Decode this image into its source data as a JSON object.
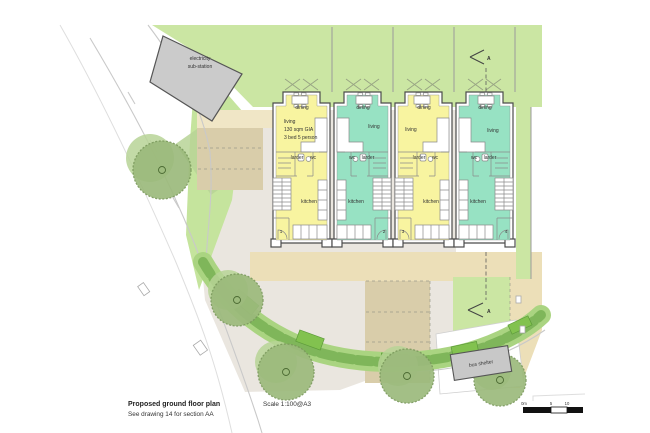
{
  "palette": {
    "garden_green": "#cbe6a3",
    "verge_green": "#c5e49d",
    "tree_green": "#9cba7c",
    "tree_green_light": "#b7d396",
    "hedge_green": "#7fb65a",
    "hedge_light": "#aad481",
    "planter_green": "#82c24f",
    "house_yellow": "#f8f4a0",
    "house_teal": "#97e2c3",
    "tan": "#ecdfb8",
    "tan_light": "#f0e6c6",
    "tan_dark": "#d9cdaa",
    "courtyard_grey": "#eae6df",
    "substation_grey": "#cbcbcb",
    "shelter_grey": "#c8c8c8"
  },
  "site": {
    "substation_line1": "electricity",
    "substation_line2": "sub-station",
    "bus_shelter": "bus shelter",
    "section_marker_top": "A",
    "section_marker_bottom": "A"
  },
  "units": [
    {
      "number": "1",
      "color": "#f8f4a0",
      "rooms": {
        "dining": "dining",
        "living": "living",
        "larder": "larder",
        "wc": "wc",
        "kitchen": "kitchen"
      },
      "note_line1": "130 sqm GIA",
      "note_line2": "3 bed 5 person"
    },
    {
      "number": "2",
      "color": "#97e2c3",
      "rooms": {
        "dining": "dining",
        "living": "living",
        "larder": "larder",
        "wc": "wc",
        "kitchen": "kitchen"
      }
    },
    {
      "number": "3",
      "color": "#f8f4a0",
      "rooms": {
        "dining": "dining",
        "living": "living",
        "larder": "larder",
        "wc": "wc",
        "kitchen": "kitchen"
      }
    },
    {
      "number": "4",
      "color": "#97e2c3",
      "rooms": {
        "dining": "dining",
        "living": "living",
        "larder": "larder",
        "wc": "wc",
        "kitchen": "kitchen"
      }
    }
  ],
  "title_block": {
    "title": "Proposed ground floor plan",
    "scale": "Scale 1:100@A3",
    "note": "See drawing 14 for section AA"
  },
  "scale_bar": {
    "tick0": "0m",
    "tick1": "5",
    "tick2": "10"
  }
}
